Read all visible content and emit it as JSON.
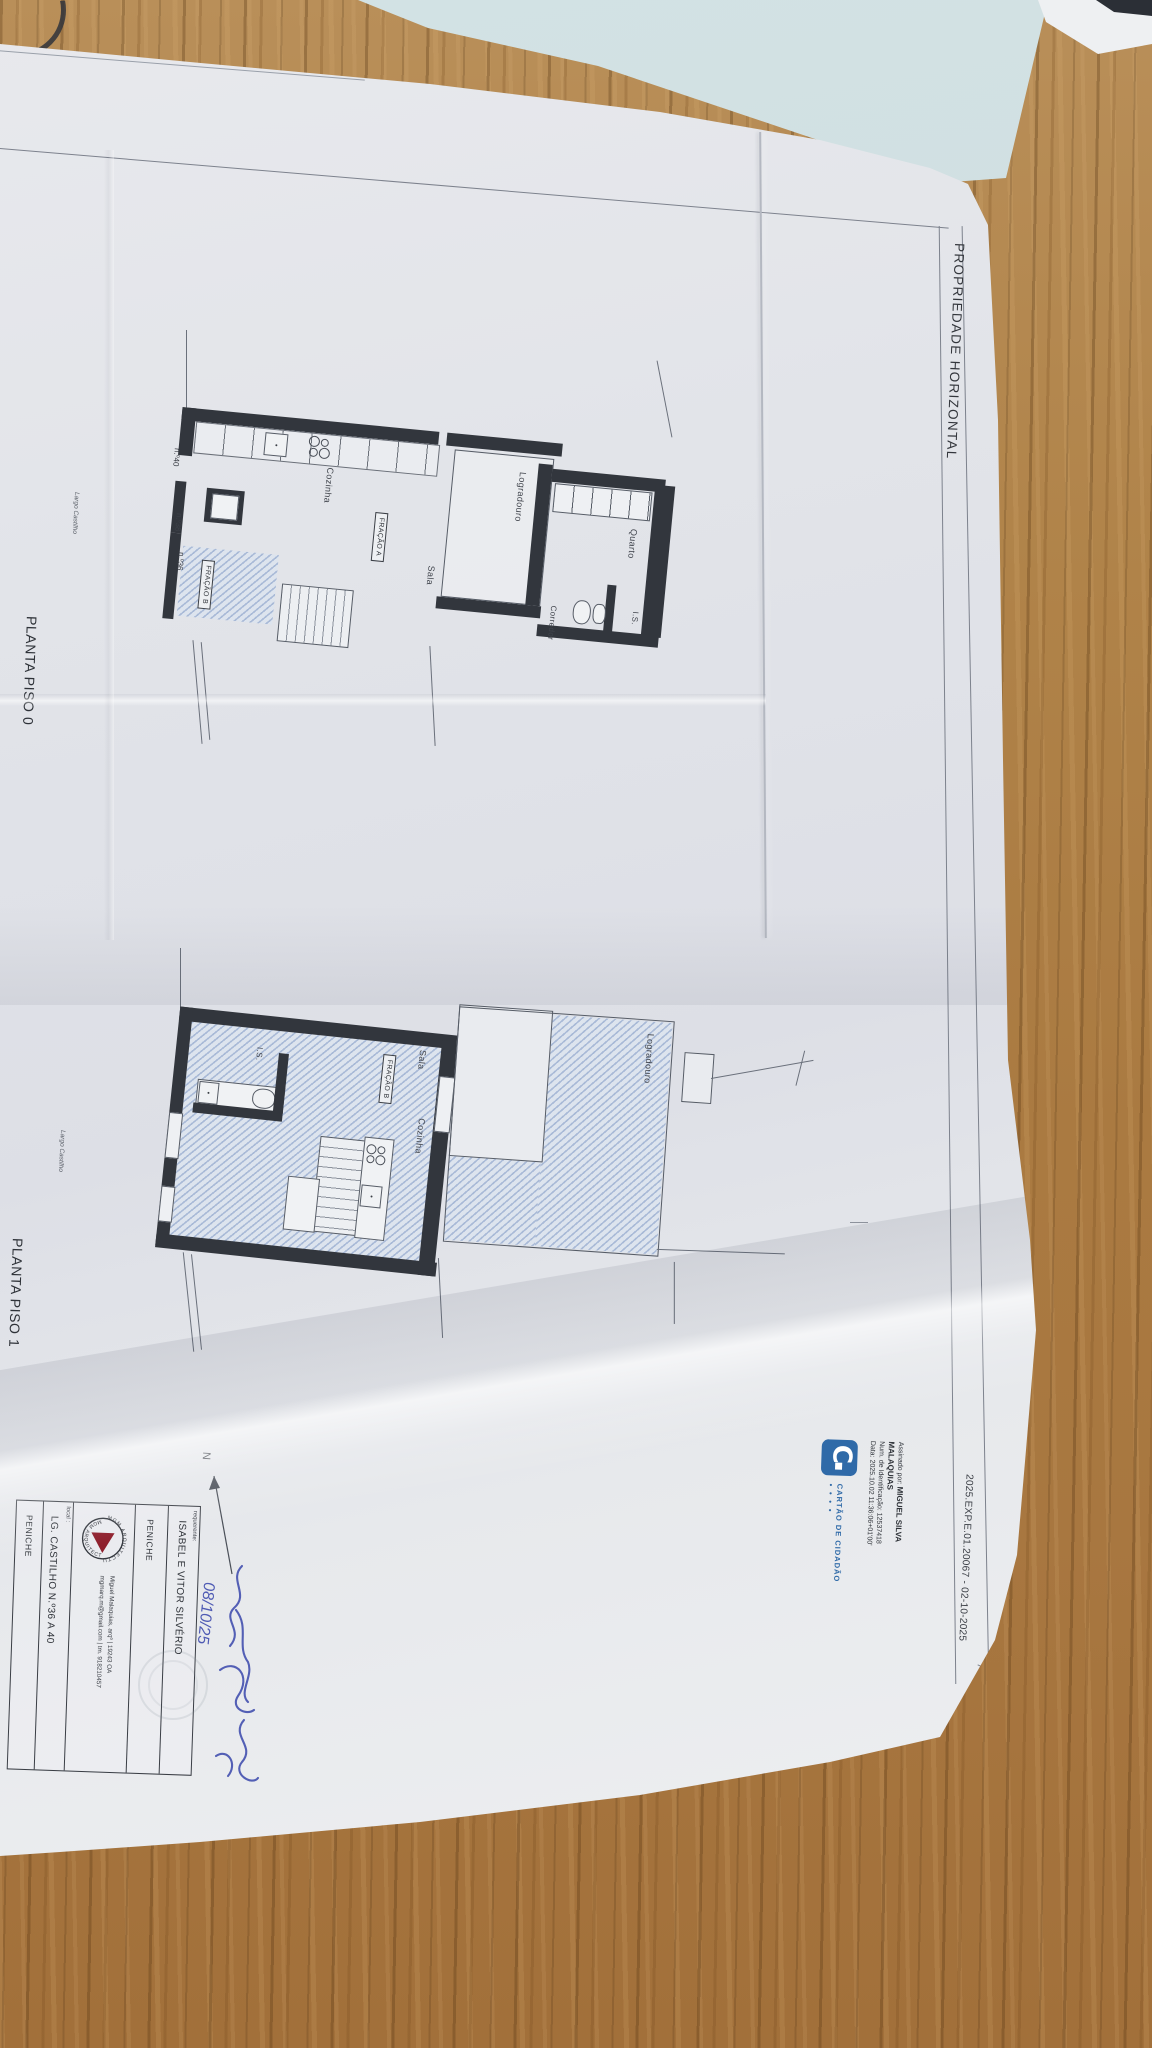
{
  "document": {
    "header_title": "PROPRIEDADE HORIZONTAL",
    "file_code": "2025.EXP.E.01.20067 - 02-10-2025"
  },
  "plan0": {
    "caption": "PLANTA PISO 0",
    "street_label": "Largo Castilho",
    "rooms": {
      "cozinha": "Cozinha",
      "sala": "Sala",
      "logradouro": "Logradouro",
      "quarto": "Quarto",
      "corredor": "Corredor",
      "is": "I.S."
    },
    "fracao_a": "FRAÇÃO A",
    "fracao_b": "FRAÇÃO B",
    "house_numbers": {
      "n40": "n.º40",
      "n38": "n.º38",
      "n36": "n.º36"
    }
  },
  "plan1": {
    "caption": "PLANTA PISO 1",
    "street_label": "Largo Castilho",
    "rooms": {
      "sala": "Sala",
      "cozinha": "Cozinha",
      "quarto": "Quarto",
      "is": "I.S.",
      "logradouro": "Logradouro"
    },
    "fracao_b": "FRAÇÃO B"
  },
  "digital_signature": {
    "signed_by_label": "Assinado por:",
    "signer_name_line1": "MIGUEL SILVA",
    "signer_name_line2": "MALAQUIAS",
    "id_line": "Num. de Identificação: 12537418",
    "date_line": "Data: 2025.10.02 11:36:06+01'00'",
    "card_label": "CARTÃO DE CIDADÃO",
    "card_dots": "● ● ● ●"
  },
  "title_block": {
    "requerente_label": "requerente:",
    "requerente_value": "ISABEL E VITOR SILVÉRIO",
    "municipality_top": "PENICHE",
    "architect_line1": "Miguel Malaquias, arqº   |   19243 OA",
    "architect_line2": "mgmarq.m@gmail.com   |   tm. 918210457",
    "local_label": "local :",
    "local_value": "LG. CASTILHO N.º36 A 40",
    "municipality_bottom": "PENICHE",
    "logo_text_top": "MGM ARQUITECTURA",
    "logo_text_bottom": "MGM ARQUITECTURA"
  },
  "annotations": {
    "handwritten_date": "08/10/25",
    "north_label": "N"
  },
  "colors": {
    "wall": "#32363d",
    "hatch_blue": "#a9bad7",
    "ink_blue": "#3f4cae",
    "cc_blue": "#2f6aa8",
    "logo_red": "#8e1f2c",
    "paper": "#e3e5ea",
    "cyan_sheet": "#ccdde0"
  }
}
